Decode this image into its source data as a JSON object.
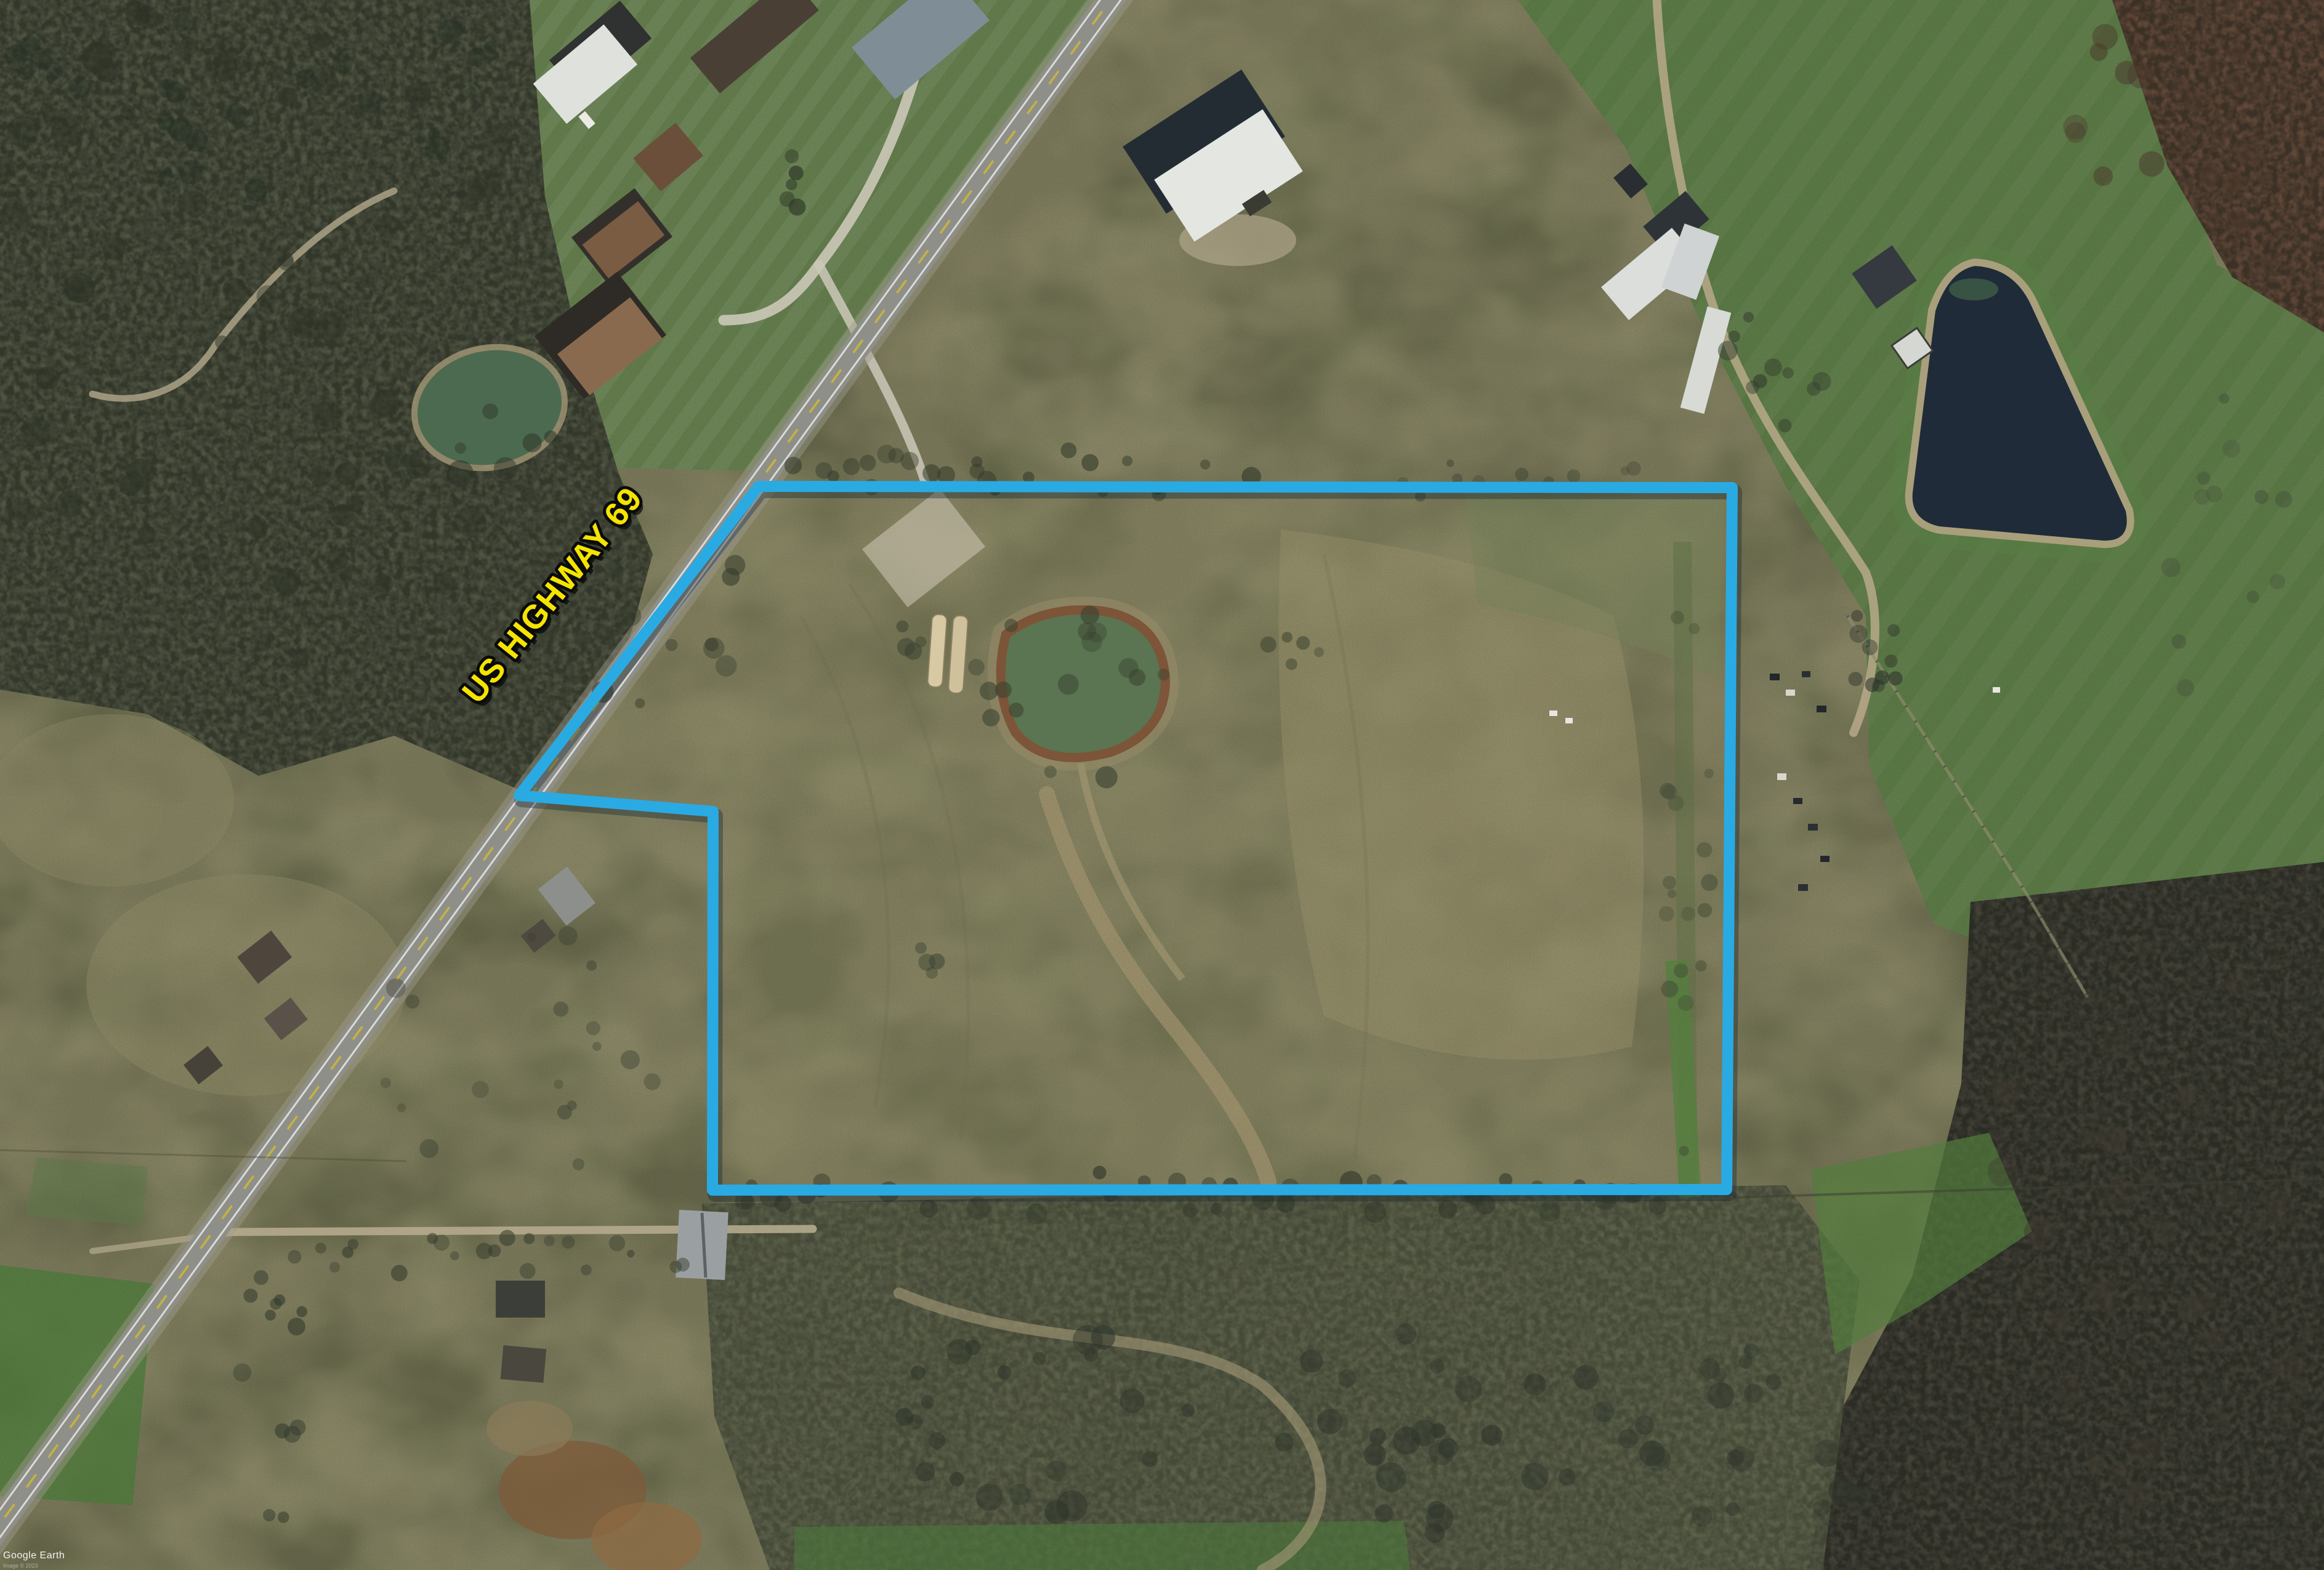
{
  "map": {
    "road_label": "US HIGHWAY 69",
    "watermark": "Google Earth",
    "attribution": "Image © 2023",
    "colors": {
      "boundary_line": "#2aaae2",
      "road_label_fill": "#f4e400",
      "road_label_outline": "#0a0a0a",
      "highway_asphalt": "#8f8f89",
      "field_base": "#7c7d5c",
      "pasture_green": "#5d7c47",
      "pond_dark_water": "#1f2b38",
      "pond_murky_water": "#5b7451"
    }
  }
}
